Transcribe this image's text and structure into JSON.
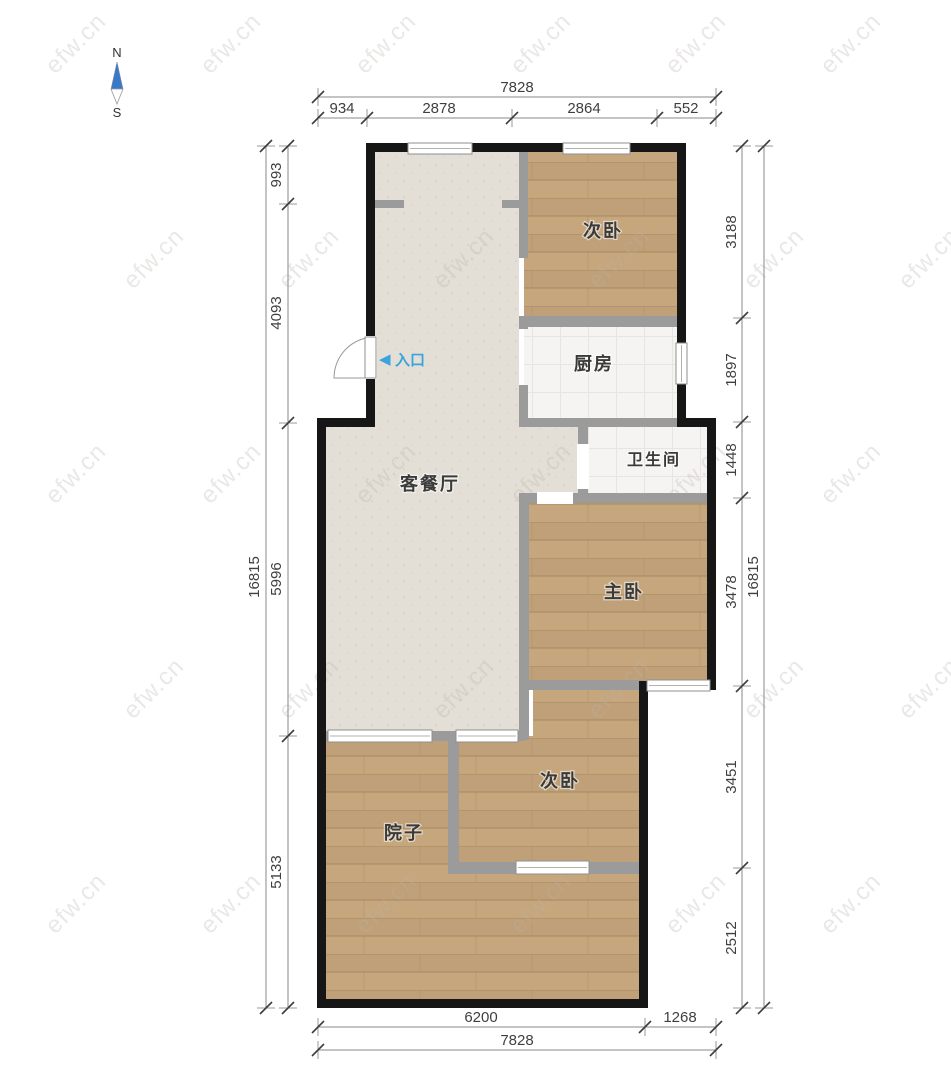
{
  "compass": {
    "north": "N",
    "south": "S"
  },
  "entrance": {
    "arrow": "◀",
    "label": "入口"
  },
  "rooms": {
    "bedroom_top": "次卧",
    "kitchen": "厨房",
    "bathroom": "卫生间",
    "living_dining": "客餐厅",
    "master_bedroom": "主卧",
    "bedroom_bottom": "次卧",
    "yard": "院子"
  },
  "dimensions": {
    "top": {
      "total": "7828",
      "segments": [
        "934",
        "2878",
        "2864",
        "552"
      ]
    },
    "bottom": {
      "total": "7828",
      "segments": [
        "6200",
        "1268"
      ]
    },
    "left": {
      "total": "16815",
      "segments": [
        "993",
        "4093",
        "5996",
        "5133"
      ]
    },
    "right": {
      "total": "16815",
      "segments": [
        "3188",
        "1897",
        "1448",
        "3478",
        "3451",
        "2512"
      ]
    }
  },
  "watermark": {
    "text": "efw.cn"
  },
  "colors": {
    "wall": "#161616",
    "partition": "#9b9b9b",
    "wood_floor": "#c6a67c",
    "wood_line": "#ab8a61",
    "living_floor": "#e3dfd6",
    "tile_floor": "#f5f4f2",
    "dimension_line": "#8a8a8a",
    "dimension_text": "#3f3f3f",
    "entrance_blue": "#3aa4dc",
    "compass_blue": "#3c78c8",
    "label_text": "#3a3a3a"
  }
}
